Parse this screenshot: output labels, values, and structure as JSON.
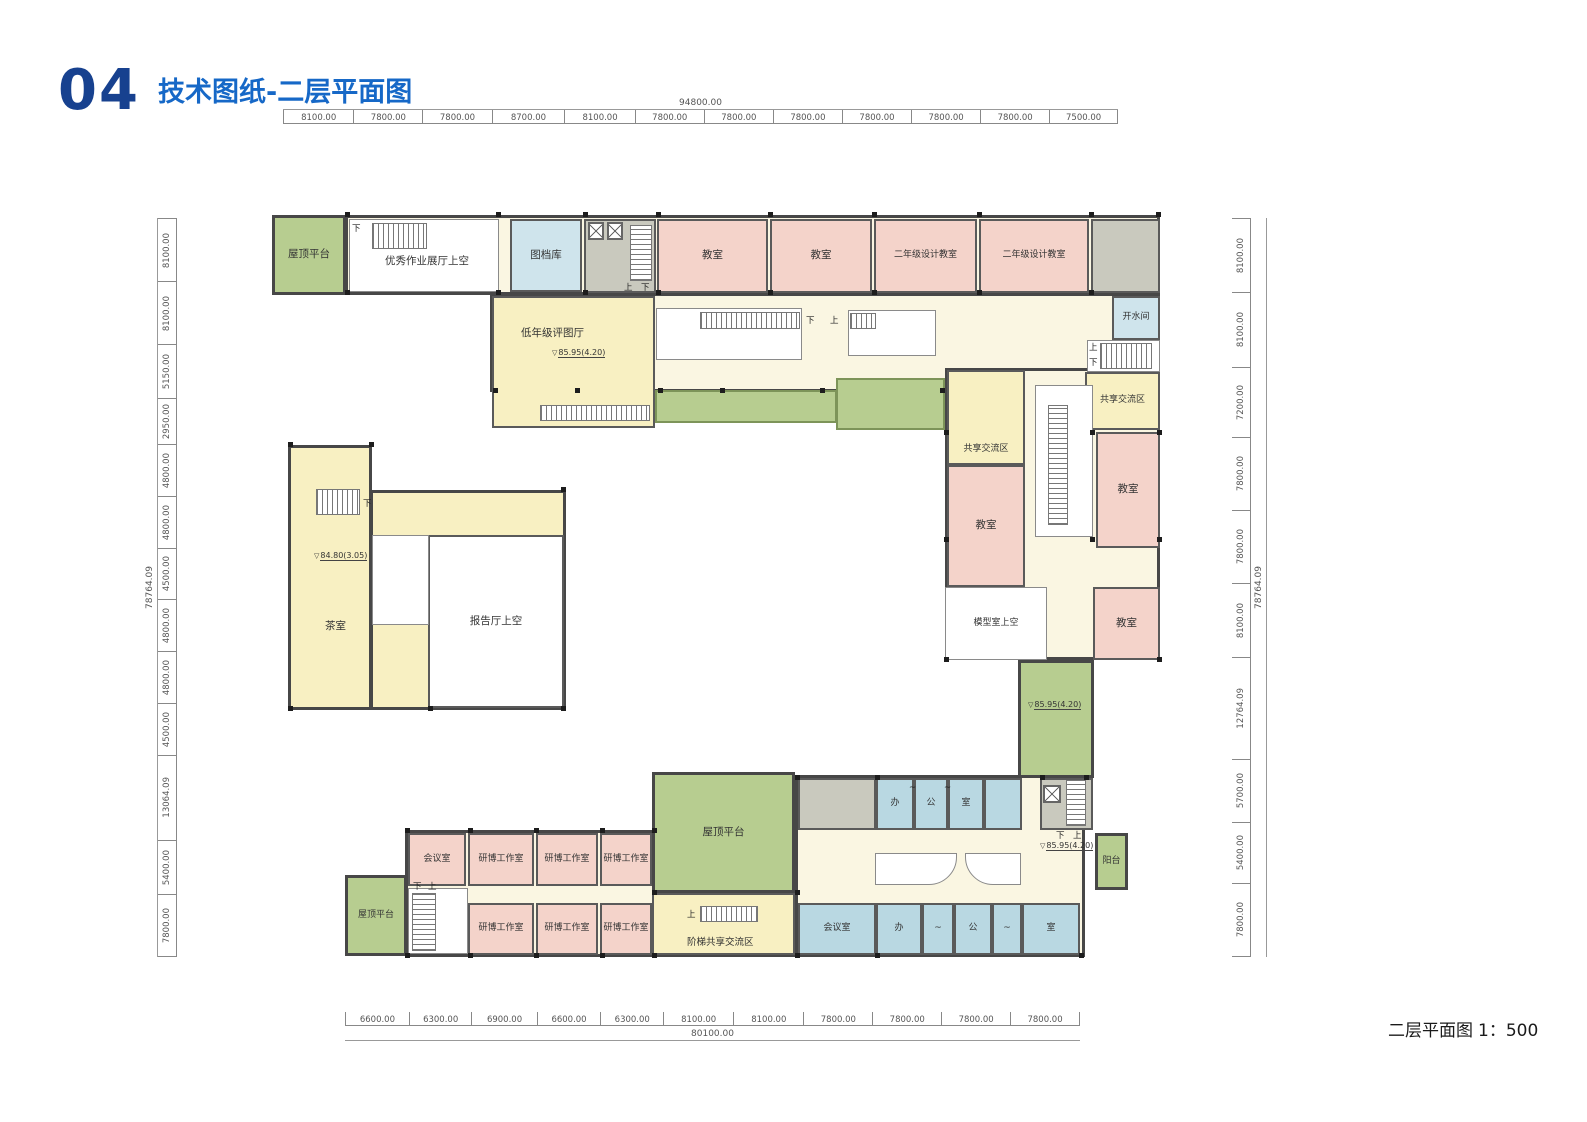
{
  "title": {
    "number": "04",
    "text": "技术图纸-二层平面图"
  },
  "footer": {
    "label": "二层平面图",
    "scale": "1：500"
  },
  "dimensions": {
    "top": {
      "total": "94800.00",
      "segments": [
        "8100.00",
        "7800.00",
        "7800.00",
        "8700.00",
        "8100.00",
        "7800.00",
        "7800.00",
        "7800.00",
        "7800.00",
        "7800.00",
        "7800.00",
        "7500.00"
      ]
    },
    "bottom": {
      "total": "80100.00",
      "segments": [
        "6600.00",
        "6300.00",
        "6900.00",
        "6600.00",
        "6300.00",
        "8100.00",
        "8100.00",
        "7800.00",
        "7800.00",
        "7800.00",
        "7800.00"
      ]
    },
    "left": {
      "total": "78764.09",
      "segments": [
        "8100.00",
        "8100.00",
        "5150.00",
        "2950.00",
        "4800.00",
        "4800.00",
        "4500.00",
        "4800.00",
        "4800.00",
        "4500.00",
        "13064.09",
        "5400.00",
        "7800.00"
      ]
    },
    "right": {
      "total": "78764.09",
      "segments": [
        "8100.00",
        "8100.00",
        "7200.00",
        "7800.00",
        "7800.00",
        "8100.00",
        "12764.09",
        "5700.00",
        "5400.00",
        "7800.00"
      ]
    }
  },
  "labels": {
    "roof_terrace": "屋顶平台",
    "exhibition_above": "优秀作业展厅上空",
    "archive": "图档库",
    "classroom": "教室",
    "grade2_design_room": "二年级设计教室",
    "water_room": "开水间",
    "junior_review_hall": "低年级评图厅",
    "shared_zone": "共享交流区",
    "tea_room": "茶室",
    "lecture_hall_above": "报告厅上空",
    "model_room_above": "模型室上空",
    "meeting_room": "会议室",
    "studio": "研博工作室",
    "stepped_shared_zone": "阶梯共享交流区",
    "balcony": "阳台",
    "office_ban": "办",
    "office_gong": "公",
    "office_shi": "室",
    "tilde": "~",
    "up": "上",
    "down": "下"
  },
  "marks": {
    "elev_main": "85.95(4.20)",
    "elev_tea": "84.80(3.05)"
  },
  "colors": {
    "title_number": "#17418f",
    "title_text": "#1668c7",
    "green": "#b7cd90",
    "pink": "#f4d3ca",
    "yellow": "#f8f0c2",
    "cream": "#faf6e2",
    "light_blue": "#cfe4ec",
    "office_blue": "#b9d8e2",
    "core_gray": "#c9c9be",
    "wall": "#4a4a4a"
  }
}
